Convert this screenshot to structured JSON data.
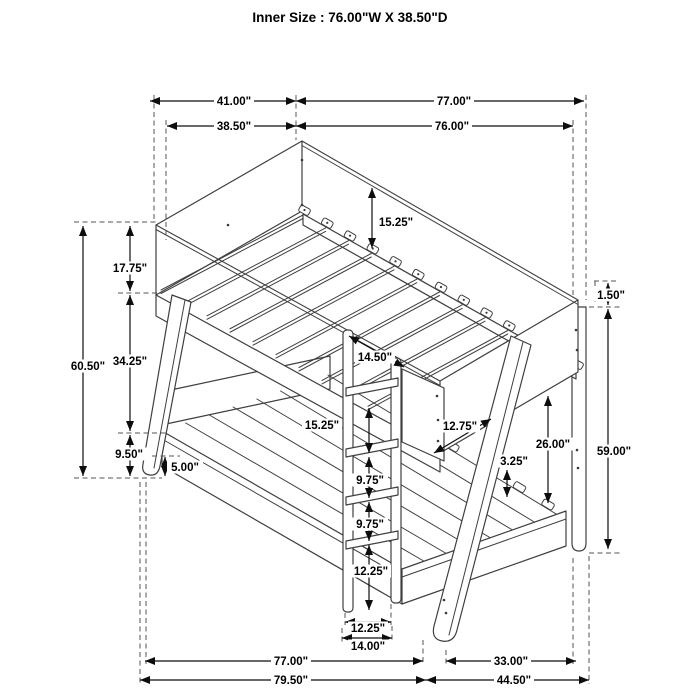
{
  "title": "Inner Size : 76.00\"W X  38.50\"D",
  "dims": {
    "top_depth_overall": "41.00\"",
    "top_length_overall": "77.00\"",
    "top_depth_inner": "38.50\"",
    "top_length_inner": "76.00\"",
    "overall_height_left": "60.50\"",
    "headboard_panel": "17.75\"",
    "bunk_gap": "34.25\"",
    "base_height": "9.50\"",
    "foot_height": "5.00\"",
    "rail_to_slat": "15.25\"",
    "front_opening": "14.50\"",
    "footboard_diag": "12.75\"",
    "ladder_top_gap": "15.25\"",
    "rung_gap_upper": "9.75\"",
    "rung_gap_lower": "9.75\"",
    "rung_floor_gap": "12.25\"",
    "ladder_width_inner": "12.25\"",
    "ladder_width_outer": "14.00\"",
    "lower_clearance": "26.00\"",
    "lower_rail_slat": "3.25\"",
    "post_top_gap": "1.50\"",
    "post_height": "59.00\"",
    "lower_length": "77.00\"",
    "side_extension": "33.00\"",
    "overall_length": "79.50\"",
    "overall_extension": "44.50\""
  }
}
